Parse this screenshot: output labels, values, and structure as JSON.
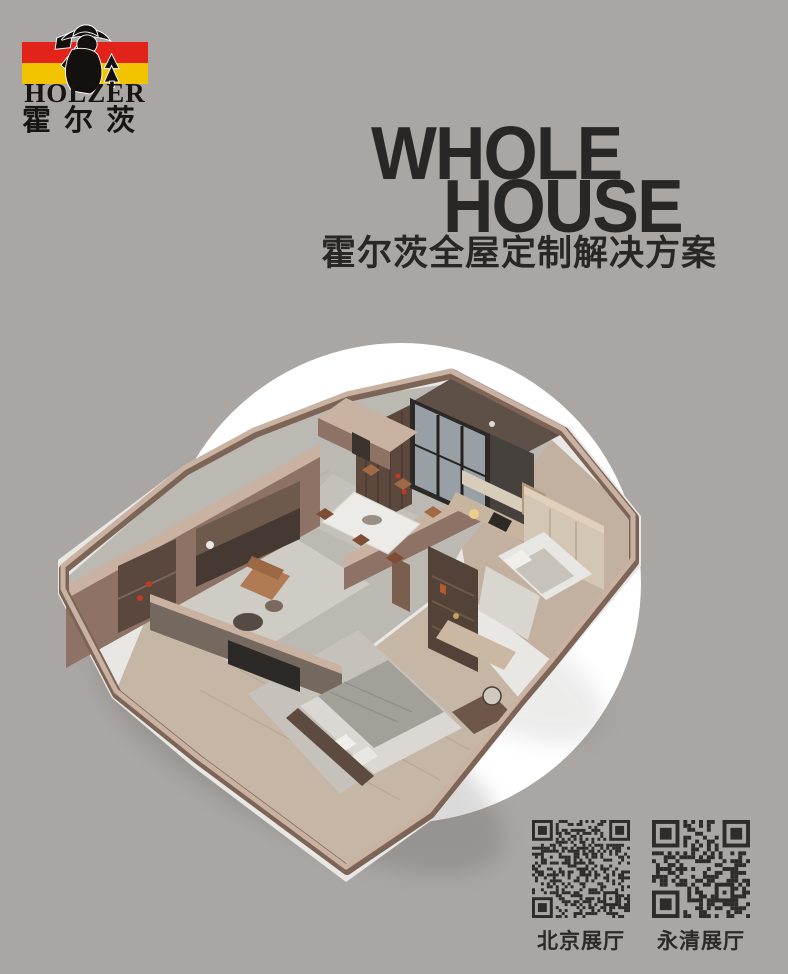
{
  "logo": {
    "brand": "HOLZER",
    "brand_cn": "霍尔茨",
    "figure_icon": "lumberjack-with-axe-and-fir-trees"
  },
  "title": {
    "line1": "WHOLE",
    "line2": "HOUSE",
    "subtitle": "霍尔茨全屋定制解决方案"
  },
  "hero": {
    "description": "isometric-3d-apartment-cutaway-render-on-white-circle"
  },
  "qr": {
    "items": [
      {
        "label": "北京展厅"
      },
      {
        "label": "永清展厅"
      }
    ]
  },
  "colors": {
    "bg": "#aaa6a3",
    "ink": "#282725",
    "brand_red": "#e2231a",
    "brand_yellow": "#f2c400",
    "flag_figure": "#14100e",
    "circle": "#ffffff",
    "qr_ink": "#2f2b28",
    "slab": "#e9e7e4",
    "wood_top": "#c9b2a1",
    "wood_face": "#8d7265",
    "wood_dark": "#7c6457",
    "wood_deep": "#5c483d",
    "charcoal": "#46413d",
    "panel_black": "#2c2927",
    "glass": "#98a0a5",
    "stone_floor": "#bcb8b2",
    "wood_floor": "#c2b1a1",
    "plank_floor": "#c5b6a5",
    "rug": "#cfccc6",
    "rug2": "#c6c2bb",
    "duvet": "#a39f99",
    "linen": "#f0efec",
    "tan_leather": "#b07a52",
    "accent_red": "#c03a24",
    "greige_cab": "#d3c6b4"
  }
}
